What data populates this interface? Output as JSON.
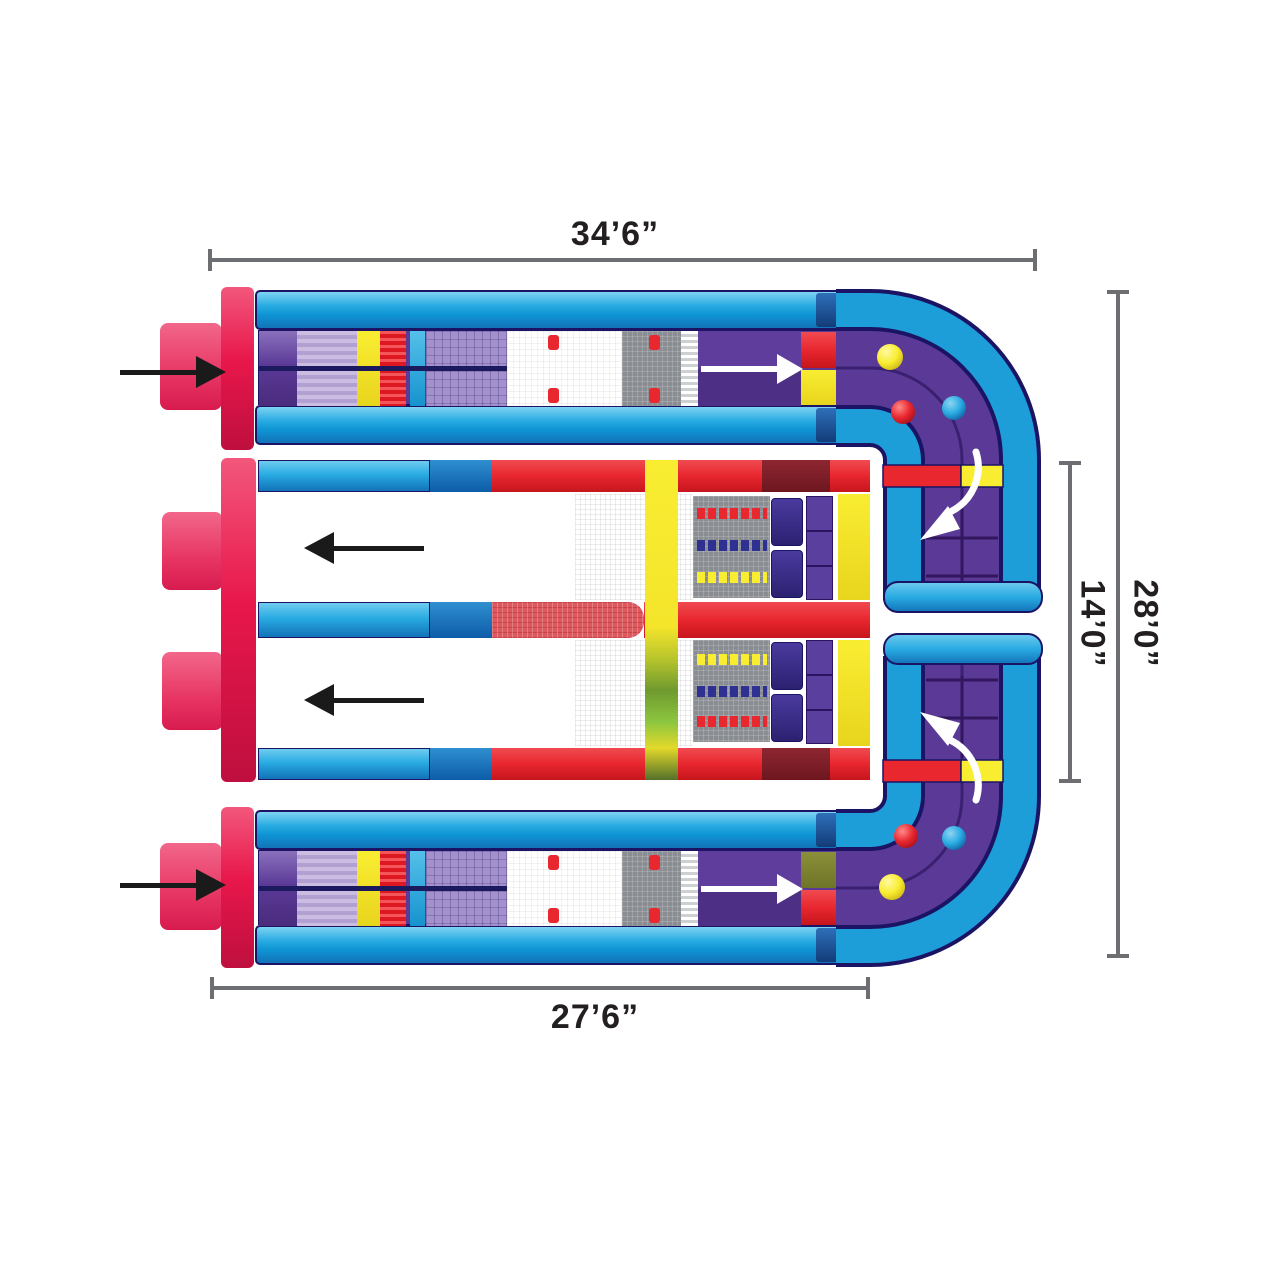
{
  "page": {
    "background": "#FFFFFF",
    "description": "Top-view plan diagram of a U-shaped inflatable obstacle course with dimension lines"
  },
  "dimensions": {
    "top": "34’6”",
    "bottom": "27’6”",
    "side_outer": "28’0”",
    "side_inner": "14’0”"
  },
  "flow": {
    "entry_arrows": [
      "entry-arrow-top",
      "entry-arrow-bottom"
    ],
    "lane_arrows": [
      "forward-arrow-top-lane",
      "forward-arrow-bottom-lane"
    ],
    "return_arrows": [
      "return-arrow-upper-lane",
      "return-arrow-lower-lane"
    ],
    "uturn_arrows": [
      "uturn-arrow-upper-curve",
      "uturn-arrow-lower-curve"
    ]
  },
  "balls": {
    "upper_curve": [
      "yellow",
      "red",
      "blue"
    ],
    "lower_curve": [
      "red",
      "blue",
      "yellow"
    ]
  },
  "colors": {
    "tube_blue": "#29ABE2",
    "deep_blue": "#1272B8",
    "navy_outline": "#1B1464",
    "track_purple": "#5B3A97",
    "lavender": "#BFAEDC",
    "red": "#E8272F",
    "crimson_cap": "#E8174B",
    "pink_block": "#EE5073",
    "yellow": "#F9ED32",
    "green": "#6F9A2F",
    "maroon": "#7A1E28",
    "olive": "#7E8432",
    "gray_panel": "#8A8E92",
    "dimension_line": "#6D6E71"
  }
}
